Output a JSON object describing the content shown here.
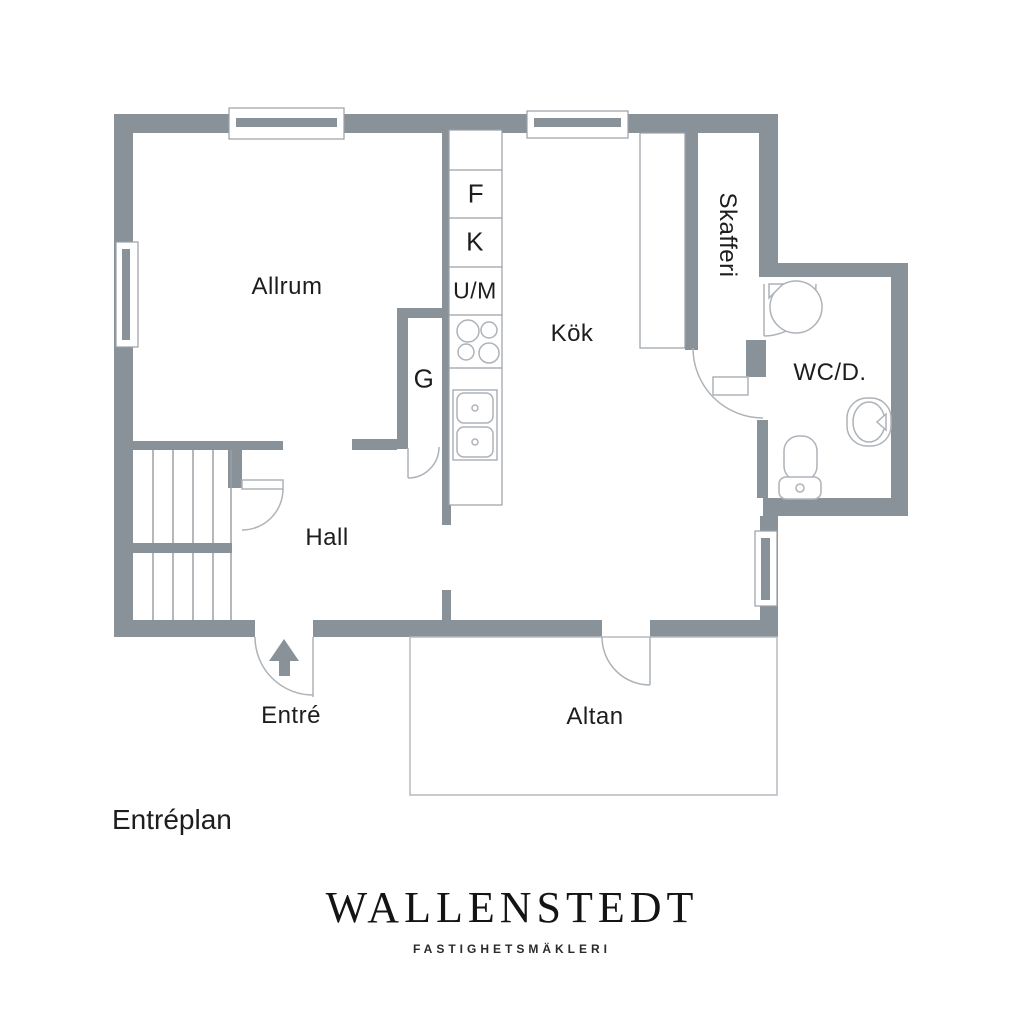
{
  "plan": {
    "floor_label": "Entréplan",
    "rooms": {
      "allrum": "Allrum",
      "kok": "Kök",
      "hall": "Hall",
      "skafferi": "Skafferi",
      "wc": "WC/D.",
      "entre": "Entré",
      "altan": "Altan"
    },
    "markers": {
      "freezer": "F",
      "fridge": "K",
      "oven_micro": "U/M",
      "wardrobe": "G"
    }
  },
  "brand": {
    "name": "WALLENSTEDT",
    "tagline": "FASTIGHETSMÄKLERI"
  },
  "colors": {
    "wall": "#8a9299",
    "detail_line": "#adb3b9",
    "stair_line": "#9aa0a6",
    "text": "#1d1d1d"
  }
}
